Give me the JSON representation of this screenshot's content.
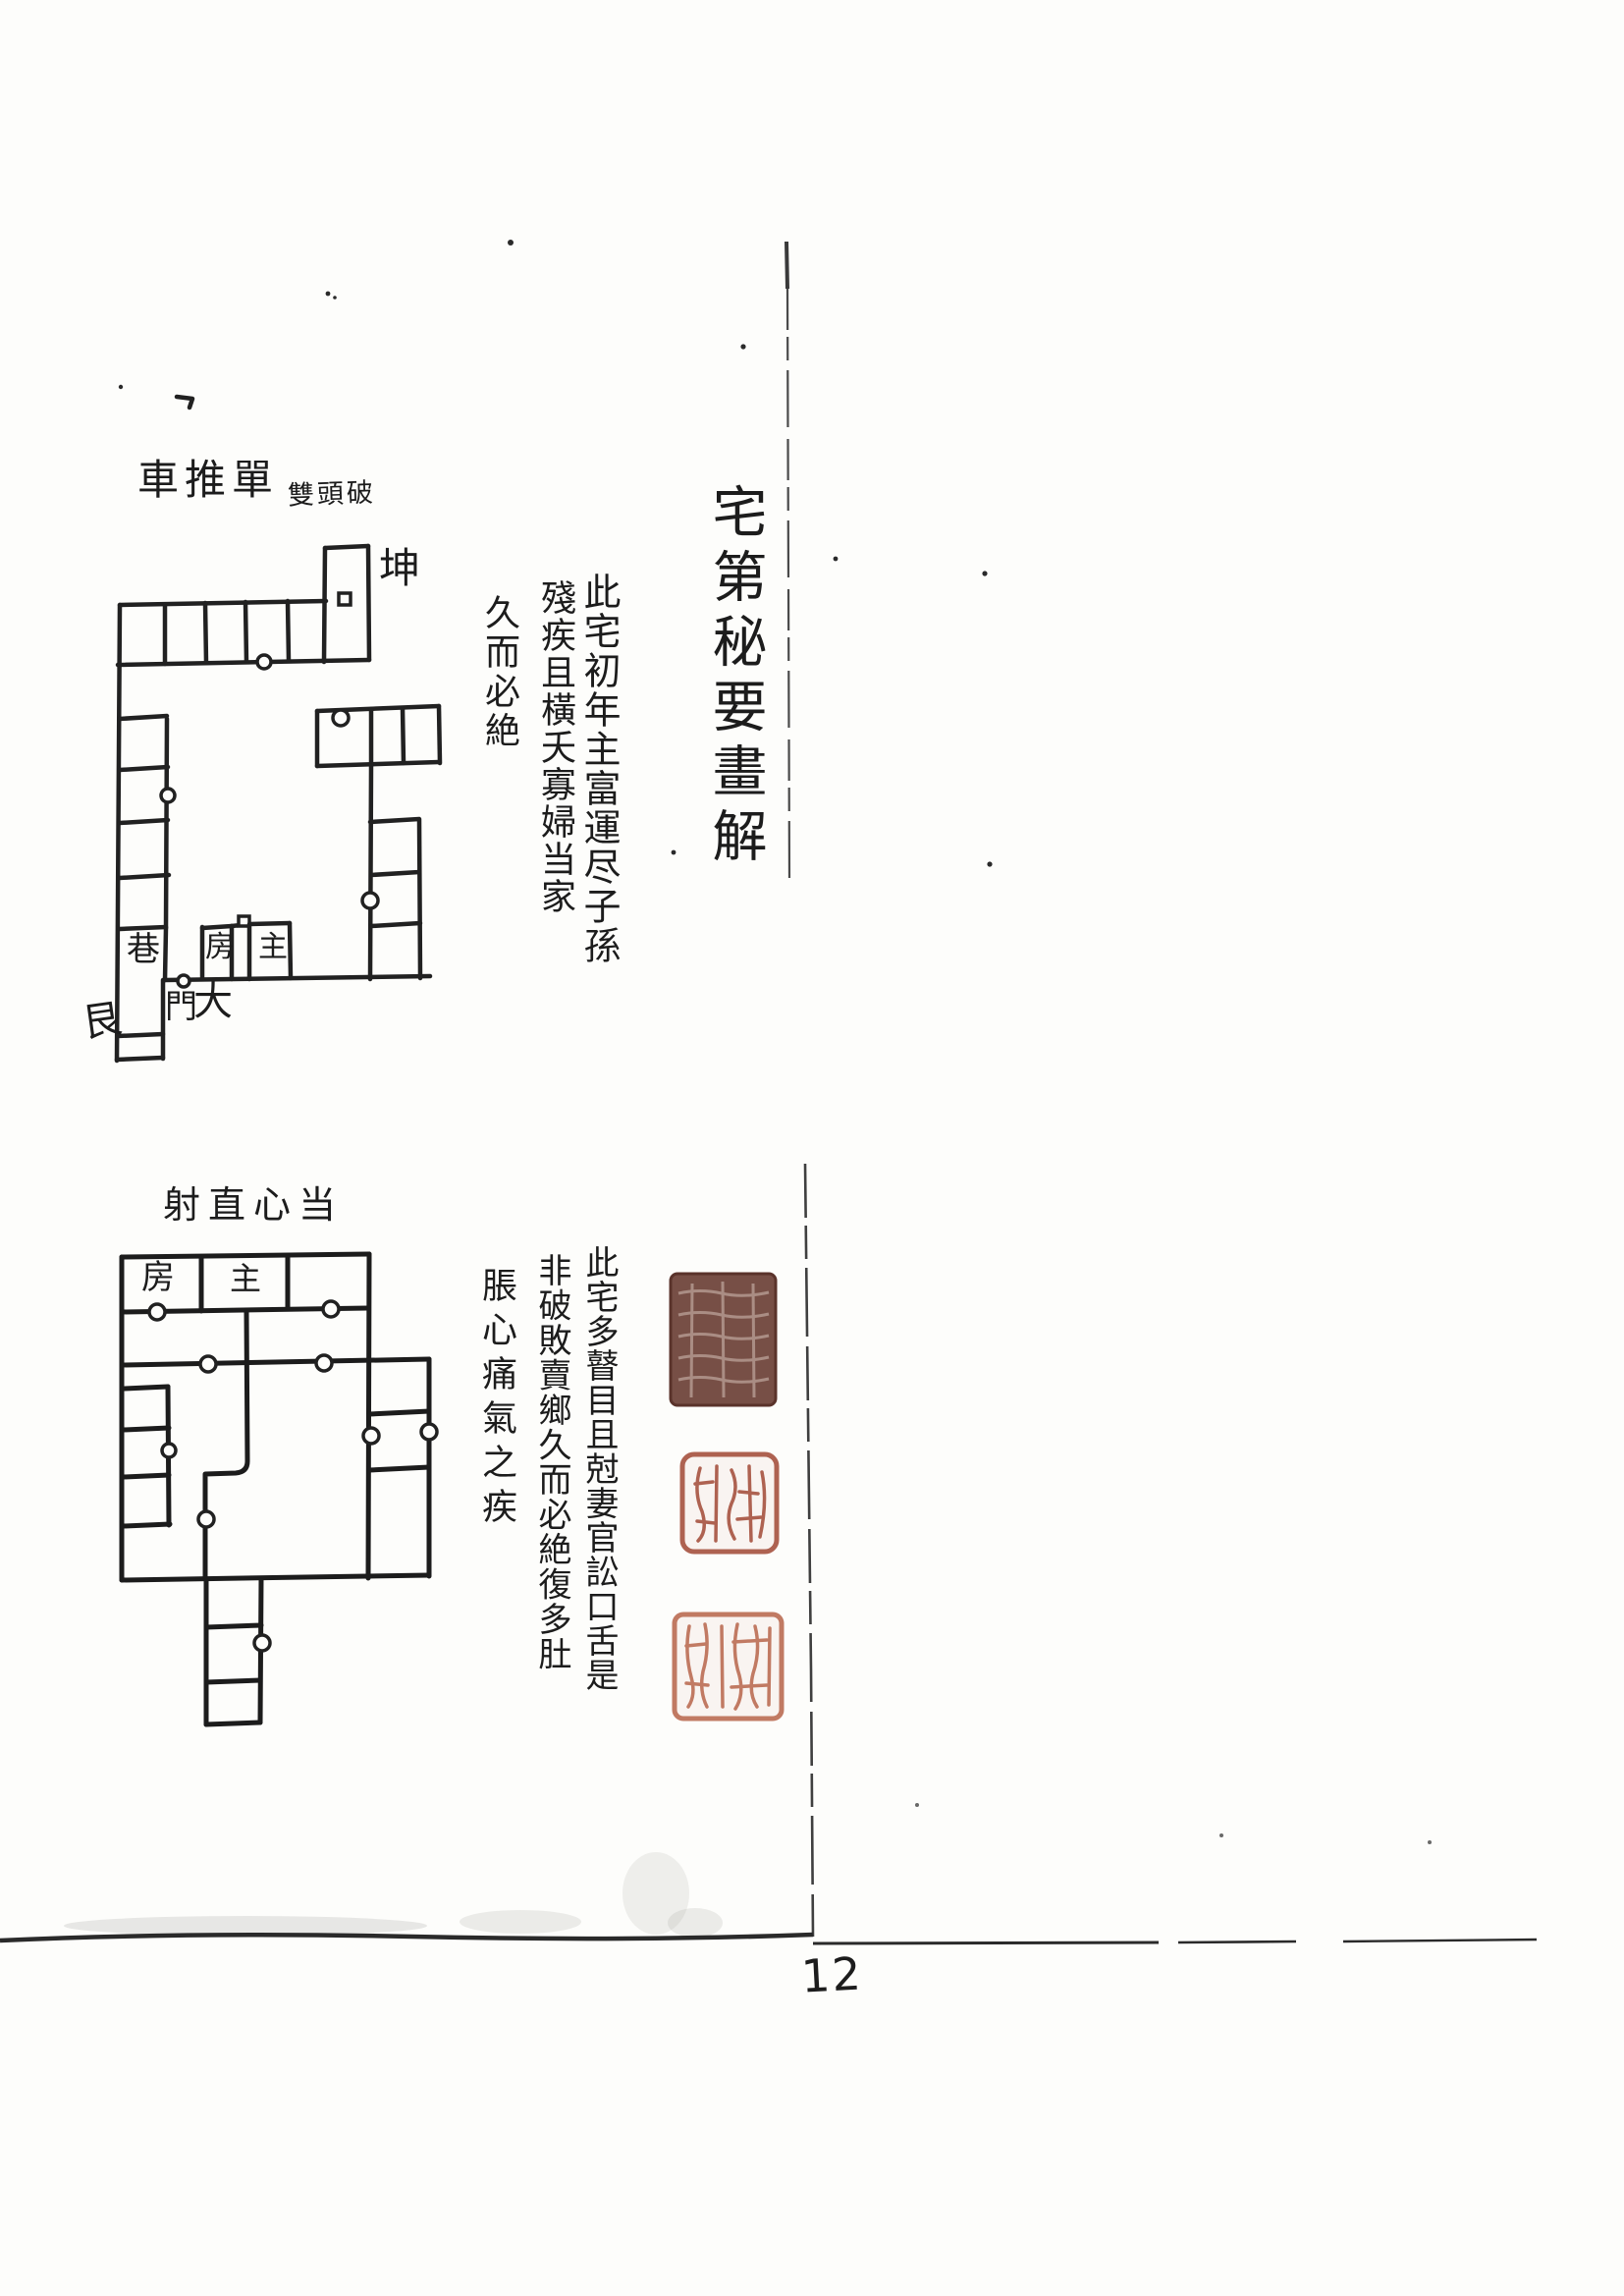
{
  "page": {
    "title_vertical": "宅第秘要畫解",
    "page_number": "12",
    "background_color": "#fdfdfb",
    "ink_color": "#1e1e1e"
  },
  "diagram1": {
    "caption": "車推單",
    "caption_note": "雙頭破",
    "trigram_top_right": "坤",
    "trigram_bottom_left": "艮",
    "labels": {
      "lane": "巷",
      "side_room": "房",
      "main_room": "主",
      "gate_char_right": "大",
      "gate_char_left": "門"
    },
    "commentary_columns": [
      "此宅初年主富運尽子孫",
      "殘疾且橫夭寡婦当家",
      "久而必絶"
    ]
  },
  "diagram2": {
    "caption": "射直心当",
    "labels": {
      "side_room": "房",
      "main_room": "主"
    },
    "commentary_columns": [
      "此宅多瞽目且尅妻官訟口舌是",
      "非破敗賣鄉久而必絶復多肚",
      "脹心痛氣之疾"
    ]
  },
  "seals": {
    "items": [
      {
        "name": "dark-square-seal",
        "color": "#6b4036"
      },
      {
        "name": "red-relief-seal",
        "color": "#a6523f"
      },
      {
        "name": "light-red-seal",
        "color": "#b9684f"
      }
    ]
  }
}
